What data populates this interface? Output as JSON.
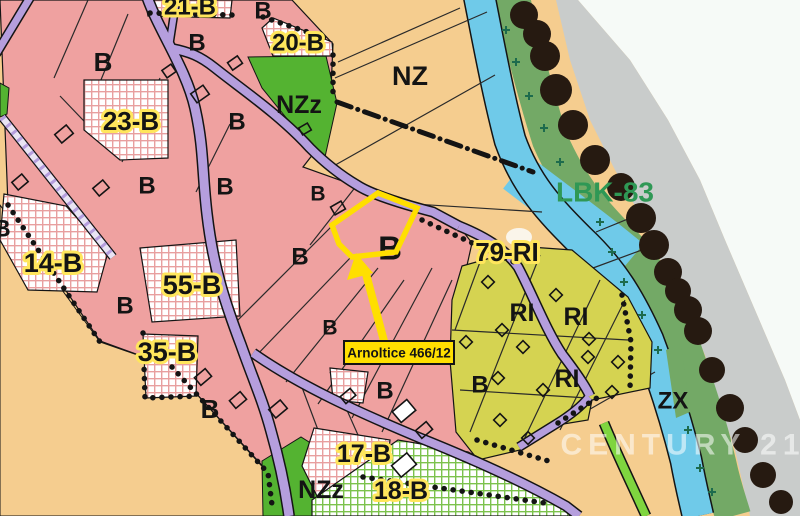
{
  "colors": {
    "pink": "#efa1a0",
    "tan": "#f5cd8f",
    "green": "#54b331",
    "gridpink": "#e89f9f",
    "gridgreen": "#7cc24c",
    "olive": "#d5d351",
    "road": "#b59edd",
    "river": "#6fcae9",
    "riparian": "#73a966",
    "pathgreen": "#7fd53f",
    "tree": "#261a11",
    "gray": "#c9cccb",
    "offwhite": "#f6faf7",
    "highlight": "#ffdf00",
    "halo": "#ffe65c",
    "lbk": "#2f9855",
    "ink": "#141414",
    "crossc": "#1d6b4d",
    "wmcolor": "#ffffff"
  },
  "zone_labels": [
    {
      "text": "21-B"
    },
    {
      "text": "20-B"
    },
    {
      "text": "23-B"
    },
    {
      "text": "14-B"
    },
    {
      "text": "55-B"
    },
    {
      "text": "35-B"
    },
    {
      "text": "17-B"
    },
    {
      "text": "18-B"
    },
    {
      "text": "79-RI"
    },
    {
      "text": "NZ"
    },
    {
      "text": "NZz"
    },
    {
      "text": "NZz"
    },
    {
      "text": "ZX"
    },
    {
      "text": "RI"
    },
    {
      "text": "RI"
    },
    {
      "text": "RI"
    },
    {
      "text": "LBK-83"
    },
    {
      "text": "B"
    },
    {
      "text": "B"
    },
    {
      "text": "B"
    },
    {
      "text": "B"
    },
    {
      "text": "B"
    },
    {
      "text": "B"
    },
    {
      "text": "B"
    },
    {
      "text": "B"
    },
    {
      "text": "B"
    },
    {
      "text": "B"
    },
    {
      "text": "B"
    },
    {
      "text": "B"
    },
    {
      "text": "B"
    },
    {
      "text": "B"
    },
    {
      "text": "B"
    }
  ],
  "highlight": {
    "label": "Arnoltice 466/12"
  },
  "watermark": {
    "text": "CENTURY 21"
  }
}
